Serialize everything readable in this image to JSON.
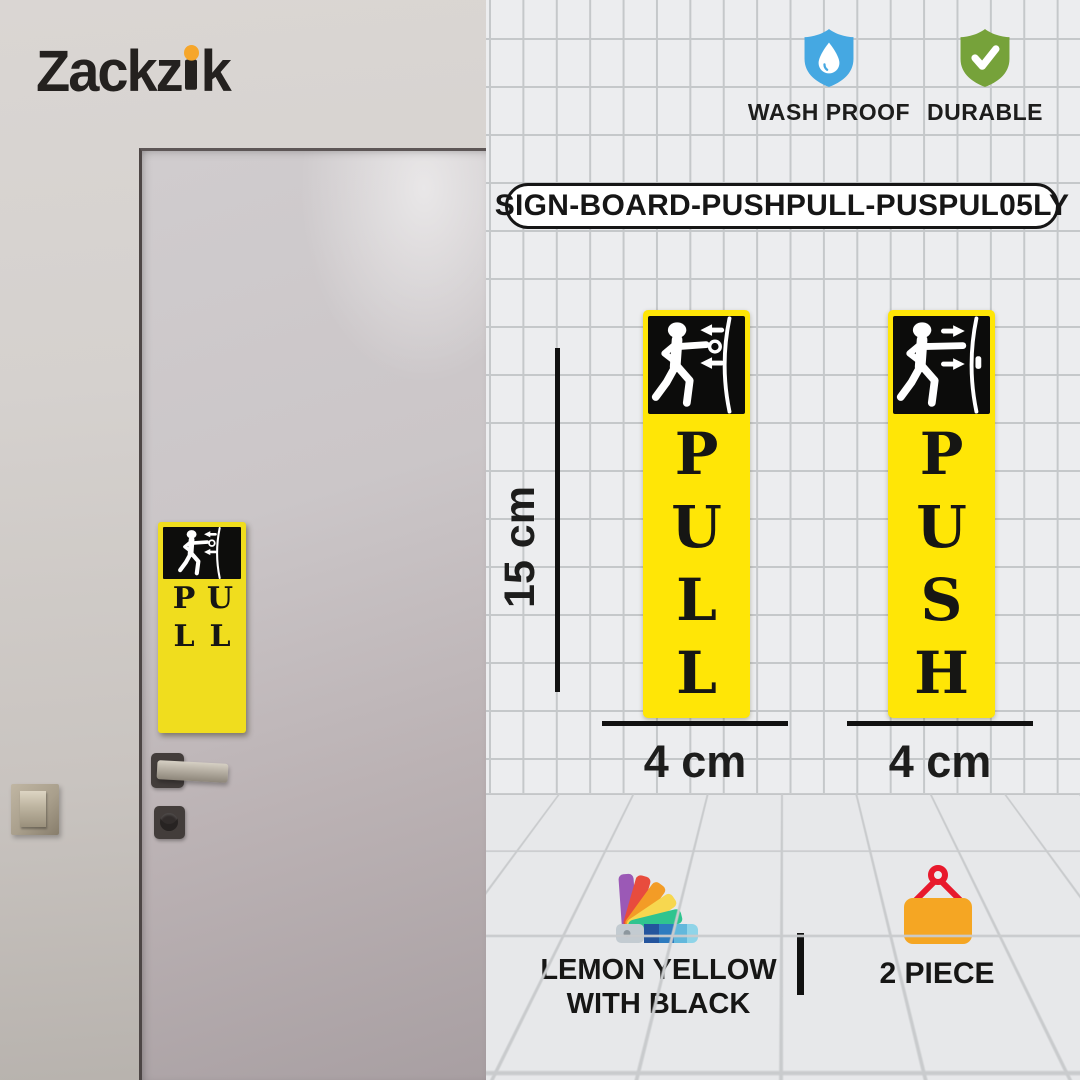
{
  "brand": {
    "name": "Zackzik",
    "part1": "Zackz",
    "part2": "k",
    "dot_color": "#F6A62A"
  },
  "badges": [
    {
      "label": "WASH PROOF",
      "icon": "shield-waterdrop-icon",
      "color": "#45A8E2"
    },
    {
      "label": "DURABLE",
      "icon": "shield-check-icon",
      "color": "#76A23A"
    }
  ],
  "sku": "SIGN-BOARD-PUSHPULL-PUSPUL05LY",
  "signs": {
    "pull": {
      "label": "PULL",
      "pictogram": "person-pulling-door",
      "bg_color": "#FFE606",
      "text_color": "#161614"
    },
    "push": {
      "label": "PUSH",
      "pictogram": "person-pushing-door",
      "bg_color": "#FFE606",
      "text_color": "#161614"
    },
    "photo": {
      "label": "PULL",
      "pictogram": "person-pulling-door"
    }
  },
  "dimensions": {
    "height": "15 cm",
    "width_pull": "4 cm",
    "width_push": "4 cm"
  },
  "features": {
    "color": {
      "line1": "LEMON YELLOW",
      "line2": "WITH BLACK",
      "icon": "color-swatch-fan-icon"
    },
    "quantity": {
      "label": "2 PIECE",
      "icon": "hanging-sign-icon",
      "sign_color": "#F5A623",
      "hanger_color": "#E8192C"
    }
  }
}
